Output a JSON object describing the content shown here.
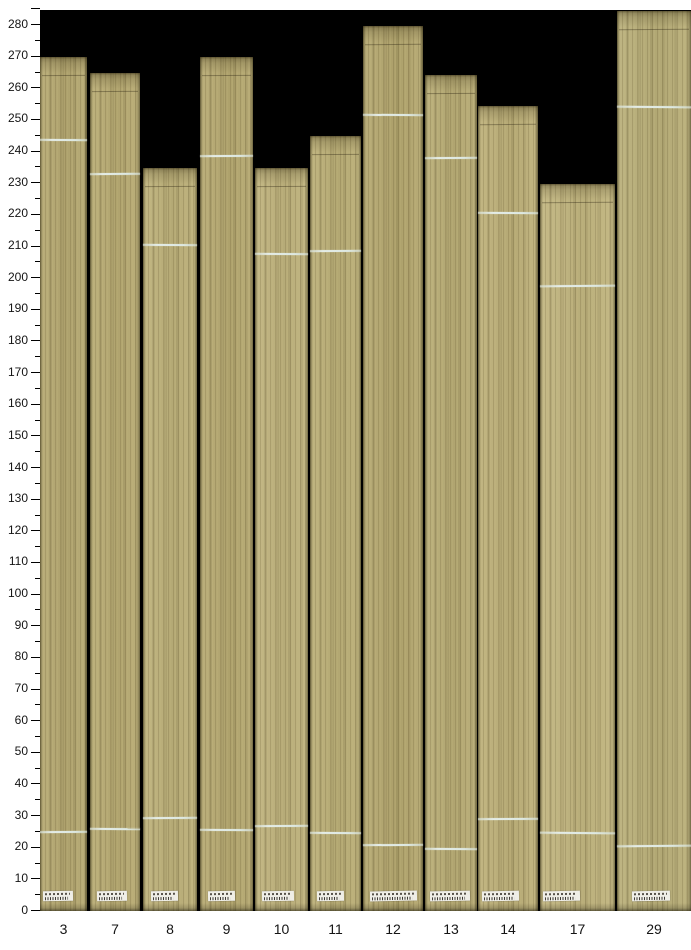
{
  "figure": {
    "page_background": "#ffffff",
    "plot_background": "#000000",
    "mark_color": "#e0eae3",
    "sticker_color": "#efeee7",
    "tick_color": "#000000",
    "label_color": "#141414"
  },
  "y_axis": {
    "min": 0,
    "max": 280,
    "major_step": 10,
    "minor_step": 5,
    "top_boundary_tick": 285,
    "labels": [
      "0",
      "10",
      "20",
      "30",
      "40",
      "50",
      "60",
      "70",
      "80",
      "90",
      "100",
      "110",
      "120",
      "130",
      "140",
      "150",
      "160",
      "170",
      "180",
      "190",
      "200",
      "210",
      "220",
      "230",
      "240",
      "250",
      "260",
      "270",
      "280"
    ]
  },
  "x_axis": {
    "labels": [
      "3",
      "7",
      "8",
      "9",
      "10",
      "11",
      "12",
      "13",
      "14",
      "17",
      "29"
    ]
  },
  "chart_data": {
    "type": "bar",
    "title": "",
    "xlabel": "",
    "ylabel": "",
    "categories": [
      "3",
      "7",
      "8",
      "9",
      "10",
      "11",
      "12",
      "13",
      "14",
      "17",
      "29"
    ],
    "values": [
      269.5,
      264.5,
      234.5,
      269.5,
      234.5,
      244.5,
      279.5,
      264,
      254,
      229.5,
      284
    ],
    "series": [
      {
        "name": "board-top-length",
        "values": [
          269.5,
          264.5,
          234.5,
          269.5,
          234.5,
          244.5,
          279.5,
          264,
          254,
          229.5,
          284
        ]
      },
      {
        "name": "upper-white-mark",
        "values": [
          243.5,
          233,
          210.5,
          238.5,
          207.5,
          208.5,
          251.5,
          238,
          220.5,
          197.5,
          254
        ]
      },
      {
        "name": "lower-white-mark",
        "values": [
          25,
          26,
          29.5,
          25.5,
          27,
          24.5,
          21,
          19.5,
          29,
          24.5,
          20.5
        ]
      }
    ],
    "ylim": [
      0,
      285
    ],
    "grid": false,
    "legend": "none",
    "bar_style": "photographed wood veneer strips on black background, each with two light horizontal marks and a small white barcode sticker near the base"
  },
  "boards": [
    {
      "id": "3",
      "x": 40,
      "width": 47,
      "color": "#b6a972",
      "sticker_dx": 3,
      "sticker_w": 30
    },
    {
      "id": "7",
      "x": 90,
      "width": 50,
      "color": "#b9ac74",
      "sticker_dx": 7,
      "sticker_w": 30
    },
    {
      "id": "8",
      "x": 143,
      "width": 54,
      "color": "#beb27b",
      "sticker_dx": 8,
      "sticker_w": 27
    },
    {
      "id": "9",
      "x": 200,
      "width": 53,
      "color": "#b7aa72",
      "sticker_dx": 8,
      "sticker_w": 27
    },
    {
      "id": "10",
      "x": 255,
      "width": 53,
      "color": "#c0b47e",
      "sticker_dx": 7,
      "sticker_w": 32
    },
    {
      "id": "11",
      "x": 310,
      "width": 51,
      "color": "#bcb078",
      "sticker_dx": 7,
      "sticker_w": 27
    },
    {
      "id": "12",
      "x": 363,
      "width": 60,
      "color": "#b5a870",
      "sticker_dx": 7,
      "sticker_w": 47
    },
    {
      "id": "13",
      "x": 425,
      "width": 52,
      "color": "#b9ad76",
      "sticker_dx": 5,
      "sticker_w": 40
    },
    {
      "id": "14",
      "x": 478,
      "width": 60,
      "color": "#beb17a",
      "sticker_dx": 4,
      "sticker_w": 37
    },
    {
      "id": "17",
      "x": 540,
      "width": 75,
      "color": "#c2b680",
      "sticker_dx": 3,
      "sticker_w": 37
    },
    {
      "id": "29",
      "x": 617,
      "width": 74,
      "color": "#bab07a",
      "sticker_dx": 15,
      "sticker_w": 38
    }
  ]
}
